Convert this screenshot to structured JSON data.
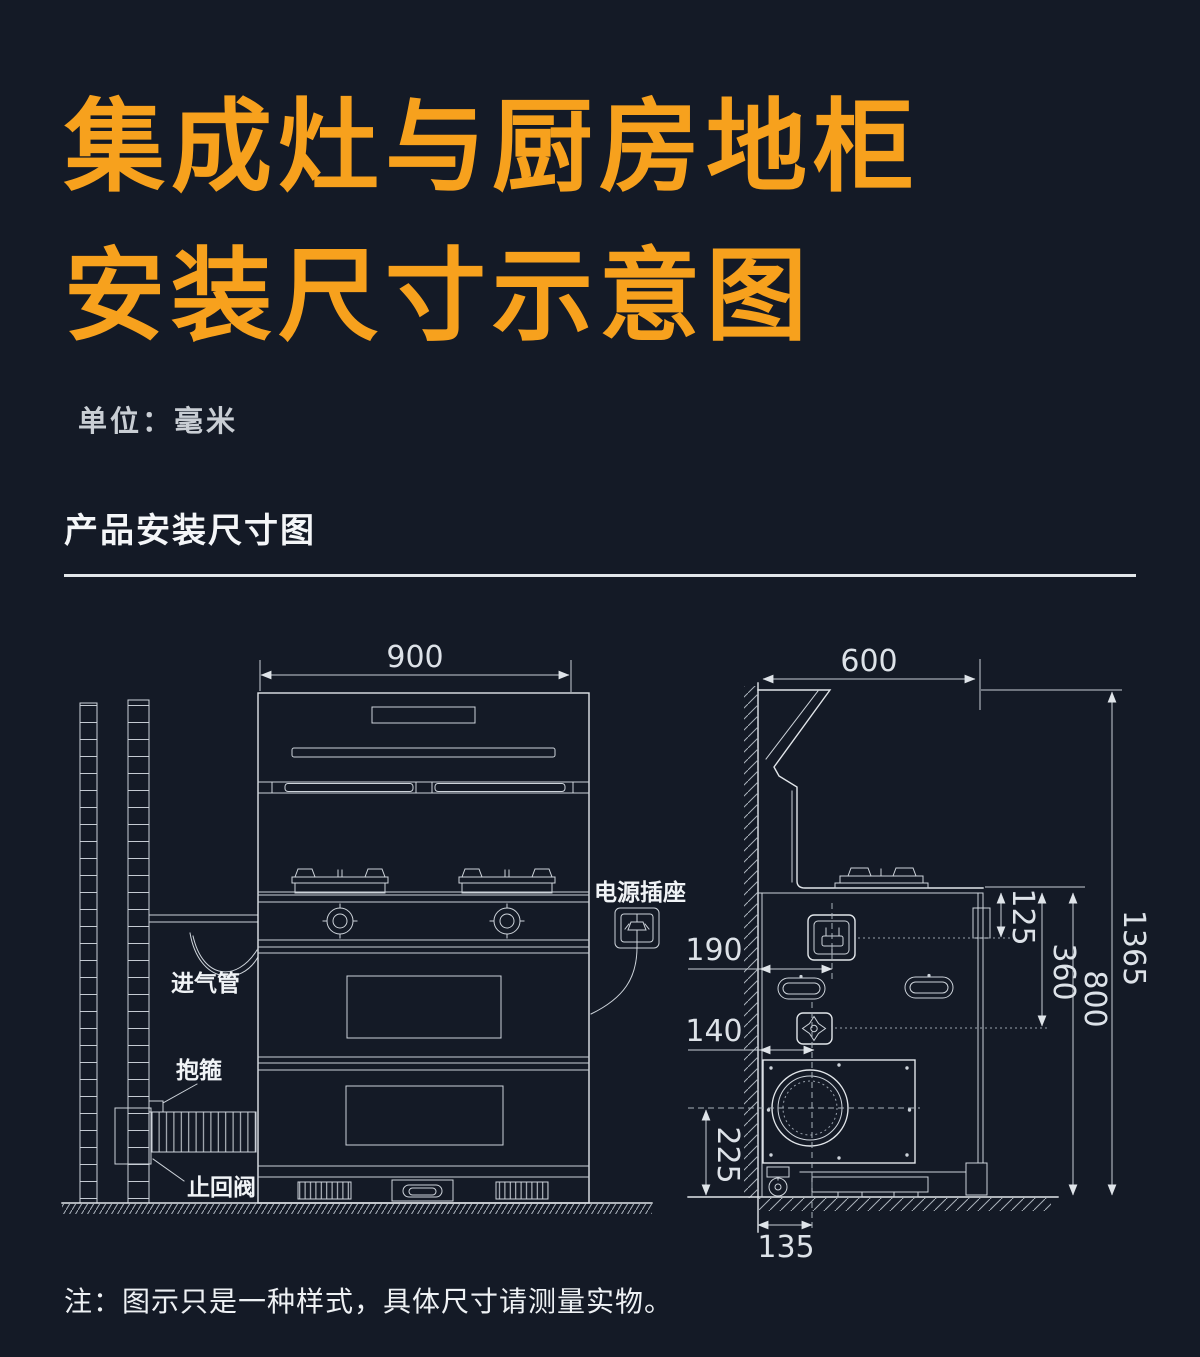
{
  "page": {
    "background_color": "#141a26",
    "accent_color": "#f7a11d",
    "line_color": "#dde2e8"
  },
  "title": {
    "line1": "集成灶与厨房地柜",
    "line2": "安装尺寸示意图"
  },
  "unit_label": "单位：毫米",
  "section_heading": "产品安装尺寸图",
  "note": "注：图示只是一种样式，具体尺寸请测量实物。",
  "front_view": {
    "dims": {
      "width": "900"
    },
    "labels": {
      "intake_pipe": "进气管",
      "clamp": "抱箍",
      "check_valve": "止回阀",
      "power_socket": "电源插座"
    }
  },
  "side_view": {
    "dims": {
      "hood_depth": "600",
      "total_height": "1365",
      "counter_height": "800",
      "counter_to_inlet_center": "360",
      "counter_to_socket_center": "125",
      "socket_center_from_wall": "190",
      "inlet_center_from_wall": "140",
      "fan_center_to_floor": "225",
      "fan_center_from_wall": "135"
    }
  }
}
